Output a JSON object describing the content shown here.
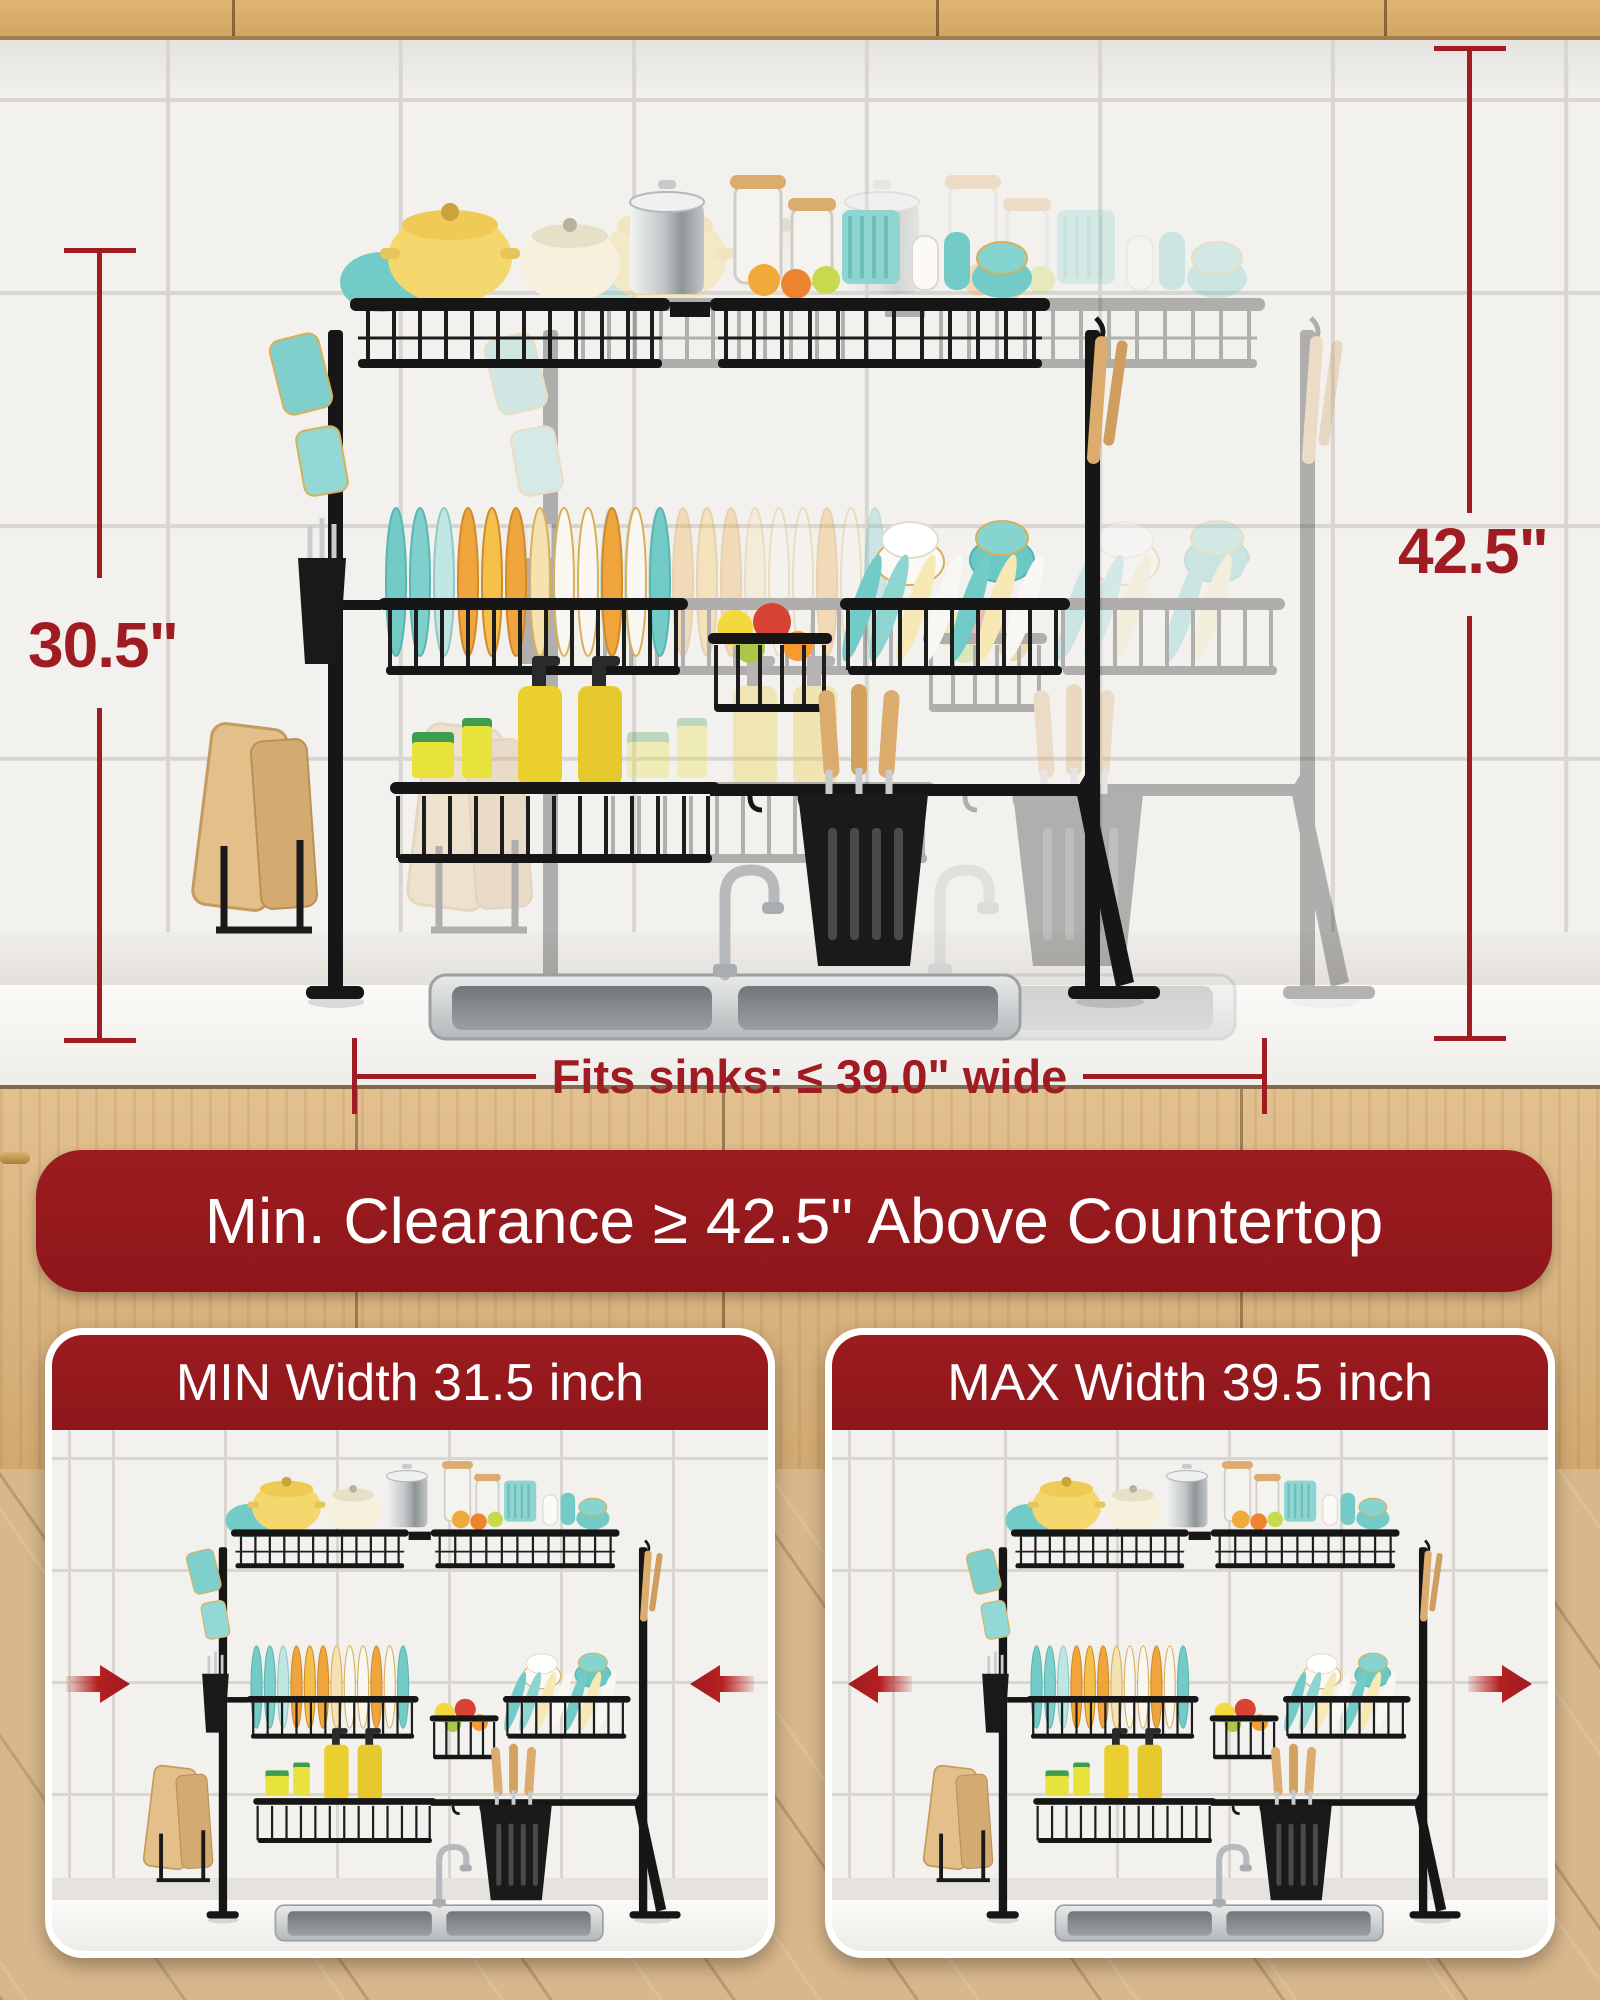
{
  "dimensions": {
    "height_left": "30.5\"",
    "clearance_right": "42.5\"",
    "sink_width": "Fits sinks: ≤ 39.0\" wide"
  },
  "banner": {
    "text": "Min. Clearance ≥ 42.5\" Above Countertop"
  },
  "cards": [
    {
      "header": "MIN Width 31.5 inch",
      "arrows": "inward"
    },
    {
      "header": "MAX Width 39.5 inch",
      "arrows": "outward"
    }
  ],
  "colors": {
    "dimension_red": "#a01c23",
    "banner_red": "#8e161b",
    "arrow_red": "#b5201f",
    "rack_black": "#161616",
    "teal": "#72cbc7",
    "wood": "#dcab6e"
  }
}
